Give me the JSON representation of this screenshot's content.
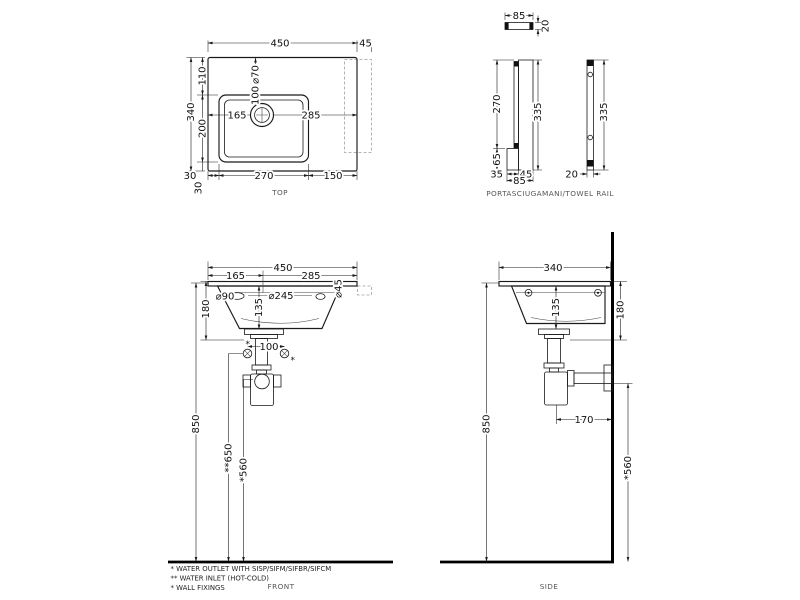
{
  "drawing": {
    "type": "washbasin technical dimension drawing",
    "units": "mm"
  },
  "top_view": {
    "caption": "TOP",
    "d450": "450",
    "d45": "45",
    "d340": "340",
    "d110": "110",
    "d200": "200",
    "d70": "⌀70",
    "d100": "100",
    "d165": "165",
    "d285": "285",
    "d30_left": "30",
    "d30_bottom": "30",
    "d270": "270",
    "d150": "150"
  },
  "towel_rail_view": {
    "caption": "PORTASCIUGAMANI/TOWEL RAIL",
    "d85_top": "85",
    "d20_top": "20",
    "d270": "270",
    "d335_front": "335",
    "d65": "65",
    "d35": "35",
    "d45": "45",
    "d85": "85",
    "d335_side": "335",
    "d20_side": "20"
  },
  "front_view": {
    "caption": "FRONT",
    "d450": "450",
    "d165": "165",
    "d285": "285",
    "d90": "⌀90",
    "d245": "⌀245",
    "d45": "⌀45",
    "d180": "180",
    "d135": "135",
    "d100": "100",
    "ast_left": "*",
    "ast_right": "*",
    "d850": "850",
    "d650": "**650",
    "d560": "*560"
  },
  "side_view": {
    "caption": "SIDE",
    "d340": "340",
    "d135": "135",
    "d180": "180",
    "d170": "170",
    "d850": "850",
    "d560": "*560"
  },
  "footnotes": {
    "outlet": "*  WATER OUTLET WITH SISP/SIFM/SIFBR/SIFCM",
    "inlet": "** WATER INLET  (HOT-COLD)",
    "fixings": "*  WALL FIXINGS"
  },
  "colors": {
    "line": "#1a1a1a",
    "hidden_line": "#9aa0a6",
    "background": "#ffffff"
  }
}
